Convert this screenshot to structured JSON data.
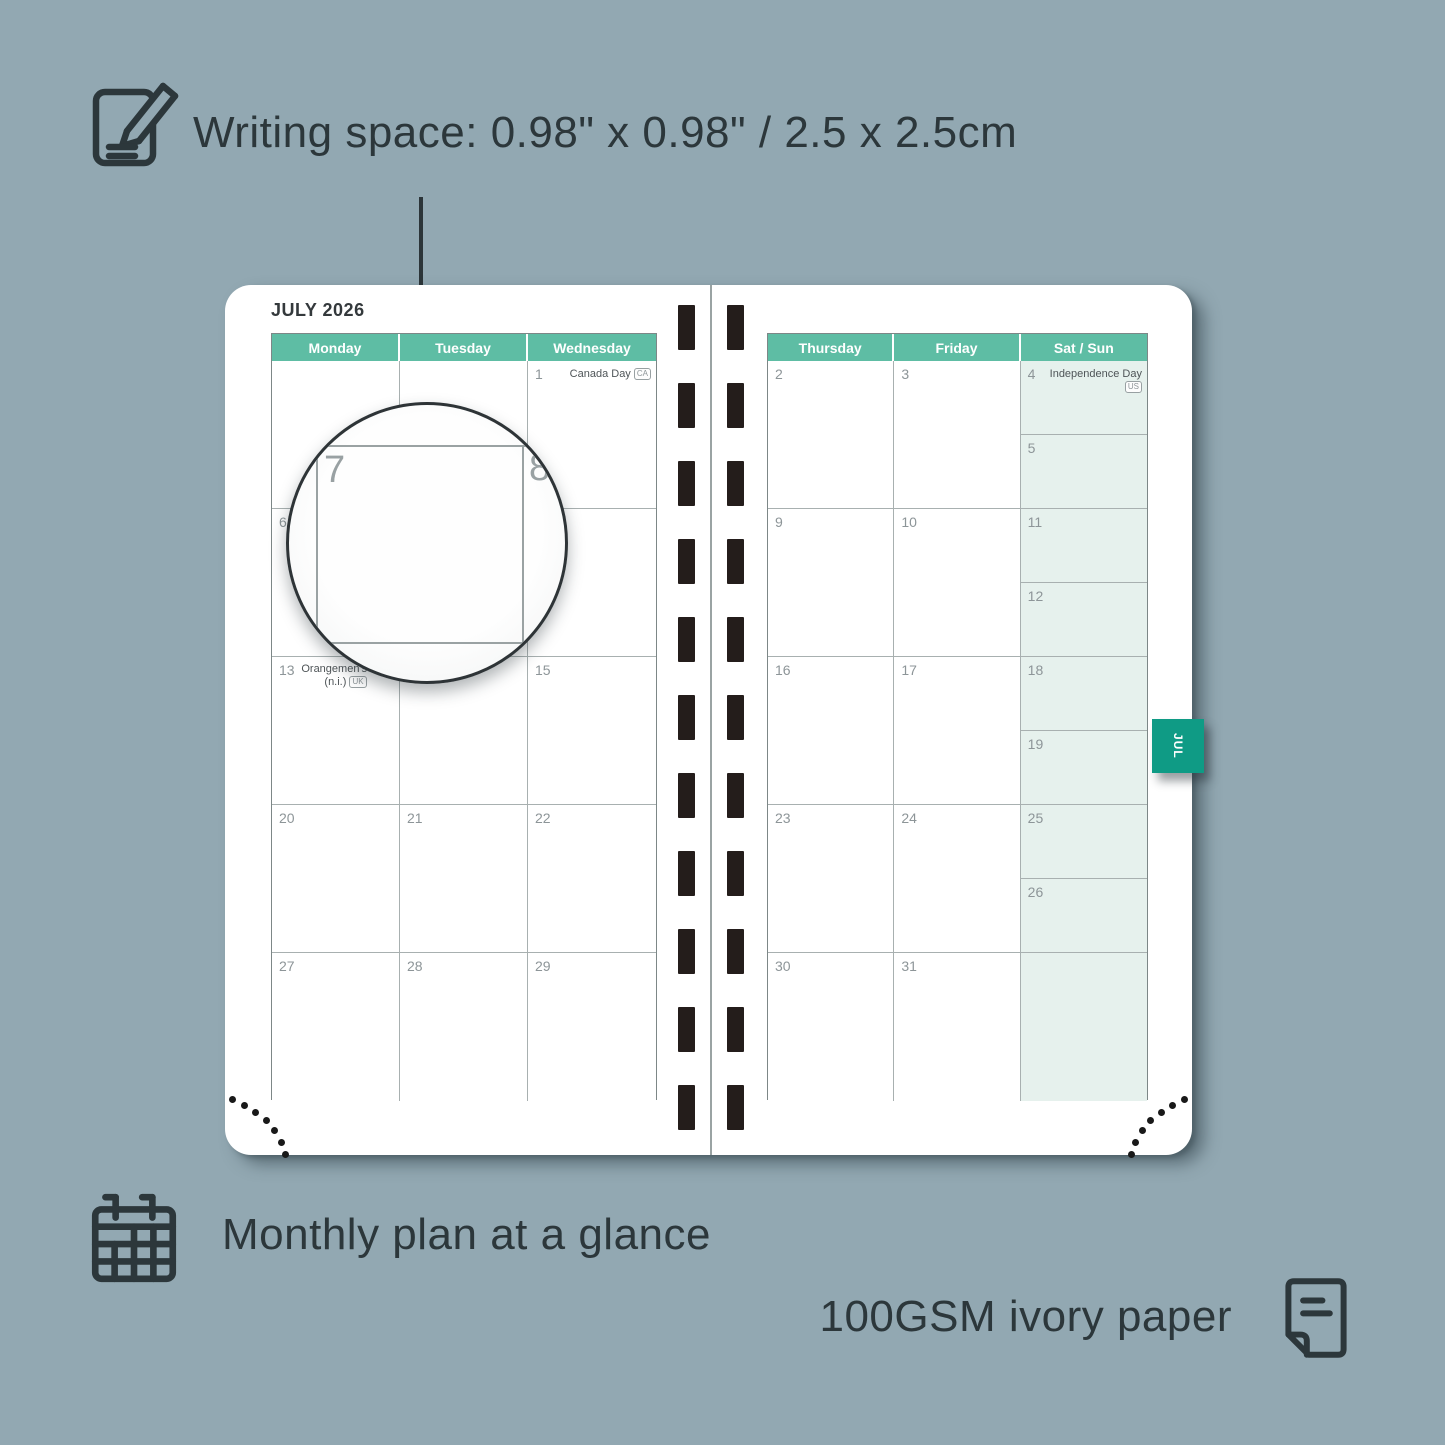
{
  "annotations": {
    "writing_space": "Writing space: 0.98\" x 0.98\" / 2.5 x 2.5cm",
    "monthly_plan": "Monthly plan at a glance",
    "paper": "100GSM ivory paper"
  },
  "icons": [
    "pencil-paper-icon",
    "calendar-grid-icon",
    "paper-sheet-icon",
    "month-tab"
  ],
  "colors": {
    "background": "#92a8b2",
    "ink": "#2c373b",
    "header_teal": "#5ebda4",
    "tab_green": "#0f9b85",
    "weekend_tint": "#e6f1ed",
    "spiral_hole": "#241d1b"
  },
  "planner": {
    "month_title": "JULY 2026",
    "tab_label": "JUL",
    "left_page": {
      "headers": [
        "Monday",
        "Tuesday",
        "Wednesday"
      ],
      "rows": [
        [
          {
            "day": ""
          },
          {
            "day": ""
          },
          {
            "day": "1",
            "holiday": "Canada Day",
            "badge": "CA"
          }
        ],
        [
          {
            "day": "6"
          },
          {
            "day": "7"
          },
          {
            "day": "8"
          }
        ],
        [
          {
            "day": "13",
            "holiday": "Orangemen's Day",
            "holiday2": "(n.i.)",
            "badge": "UK"
          },
          {
            "day": "14"
          },
          {
            "day": "15"
          }
        ],
        [
          {
            "day": "20"
          },
          {
            "day": "21"
          },
          {
            "day": "22"
          }
        ],
        [
          {
            "day": "27"
          },
          {
            "day": "28"
          },
          {
            "day": "29"
          }
        ]
      ]
    },
    "right_page": {
      "headers": [
        "Thursday",
        "Friday",
        "Sat / Sun"
      ],
      "rows": [
        [
          {
            "day": "2"
          },
          {
            "day": "3"
          },
          {
            "split": [
              {
                "day": "4",
                "holiday": "Independence Day",
                "badge": "US"
              },
              {
                "day": "5"
              }
            ]
          }
        ],
        [
          {
            "day": "9"
          },
          {
            "day": "10"
          },
          {
            "split": [
              {
                "day": "11"
              },
              {
                "day": "12"
              }
            ]
          }
        ],
        [
          {
            "day": "16"
          },
          {
            "day": "17"
          },
          {
            "split": [
              {
                "day": "18"
              },
              {
                "day": "19"
              }
            ]
          }
        ],
        [
          {
            "day": "23"
          },
          {
            "day": "24"
          },
          {
            "split": [
              {
                "day": "25"
              },
              {
                "day": "26"
              }
            ]
          }
        ],
        [
          {
            "day": "30"
          },
          {
            "day": "31"
          },
          {
            "tint": true,
            "day": ""
          }
        ]
      ]
    }
  },
  "magnifier": {
    "day_large": "7",
    "day_next": "8"
  }
}
